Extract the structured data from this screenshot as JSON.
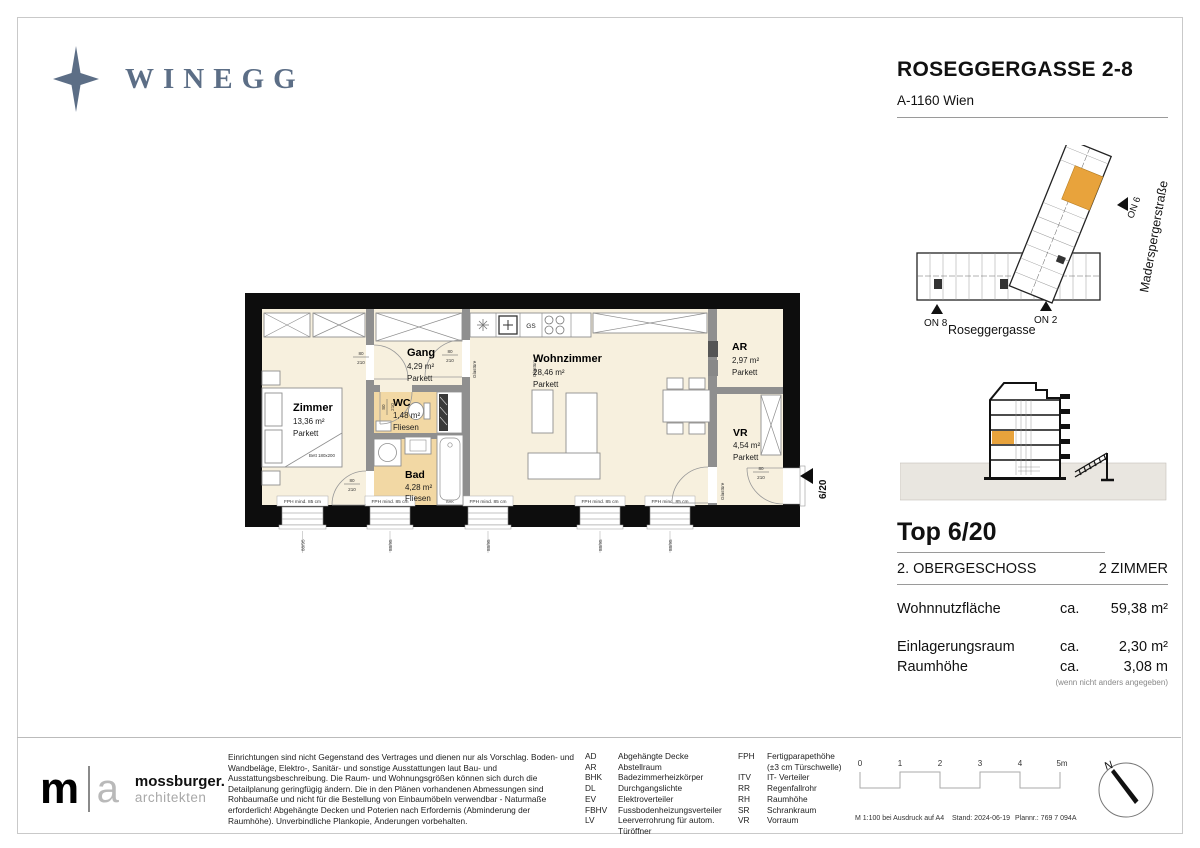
{
  "brand": {
    "name": "WINEGG",
    "color": "#5c6e86"
  },
  "header": {
    "title": "ROSEGGERGASSE 2-8",
    "subtitle": "A-1160 Wien"
  },
  "site_plan": {
    "street_bottom": "Roseggergasse",
    "street_side": "Maderspergerstraße",
    "marker_on8": "ON 8",
    "marker_on2": "ON 2",
    "marker_on6": "ON 6",
    "highlight_color": "#e8a33c"
  },
  "unit": {
    "title": "Top 6/20",
    "floor": "2. OBERGESCHOSS",
    "rooms": "2 ZIMMER",
    "metrics": [
      {
        "label": "Wohnnutzfläche",
        "approx": "ca.",
        "value": "59,38 m²"
      },
      {
        "label": "Einlagerungsraum",
        "approx": "ca.",
        "value": "2,30 m²"
      },
      {
        "label": "Raumhöhe",
        "approx": "ca.",
        "value": "3,08 m"
      }
    ],
    "note": "(wenn nicht anders angegeben)"
  },
  "plan": {
    "rooms": [
      {
        "name": "Zimmer",
        "area": "13,36 m²",
        "floor": "Parkett"
      },
      {
        "name": "Gang",
        "area": "4,29 m²",
        "floor": "Parkett"
      },
      {
        "name": "WC",
        "area": "1,48 m²",
        "floor": "Fliesen"
      },
      {
        "name": "Bad",
        "area": "4,28 m²",
        "floor": "Fliesen"
      },
      {
        "name": "Wohnzimmer",
        "area": "28,46 m²",
        "floor": "Parkett"
      },
      {
        "name": "AR",
        "area": "2,97 m²",
        "floor": "Parkett"
      },
      {
        "name": "VR",
        "area": "4,54 m²",
        "floor": "Parkett"
      }
    ],
    "bed_label": "Bett 180x200",
    "gs_label": "GS",
    "bhk_label": "BHK",
    "glass_door_label": "Glastüre",
    "door_width": "80",
    "door_height": "210",
    "window_label": "FPH mind. 85 cm",
    "window_dim": "88/95",
    "entry_marker": "6/20"
  },
  "footer": {
    "architect": {
      "m": "m",
      "a": "a",
      "name": "mossburger.",
      "sub": "architekten"
    },
    "disclaimer": "Einrichtungen sind nicht Gegenstand des Vertrages und dienen nur als Vorschlag. Boden- und Wandbeläge, Elektro-, Sanitär- und sonstige Ausstattungen laut Bau- und Ausstattungsbeschreibung. Die Raum- und Wohnungsgrößen können sich durch die Detailplanung geringfügig ändern. Die in den Plänen vorhandenen Abmessungen sind Rohbaumaße und nicht für die Bestellung von Einbaumöbeln verwendbar - Naturmaße erforderlich! Abgehängte Decken und Poterien nach Erfordernis (Abminderung der Raumhöhe). Unverbindliche Plankopie, Änderungen vorbehalten.",
    "legend_col1": [
      {
        "abbr": "AD",
        "label": "Abgehängte Decke"
      },
      {
        "abbr": "AR",
        "label": "Abstellraum"
      },
      {
        "abbr": "BHK",
        "label": "Badezimmerheizkörper"
      },
      {
        "abbr": "DL",
        "label": "Durchgangslichte"
      },
      {
        "abbr": "EV",
        "label": "Elektroverteiler"
      },
      {
        "abbr": "FBHV",
        "label": "Fussbodenheizungsverteiler"
      },
      {
        "abbr": "LV",
        "label": "Leerverrohrung für autom. Türöffner"
      }
    ],
    "legend_col2": [
      {
        "abbr": "FPH",
        "label": "Fertigparapethöhe"
      },
      {
        "abbr": "",
        "label": "(±3 cm Türschwelle)"
      },
      {
        "abbr": "ITV",
        "label": "IT- Verteiler"
      },
      {
        "abbr": "RR",
        "label": "Regenfallrohr"
      },
      {
        "abbr": "RH",
        "label": "Raumhöhe"
      },
      {
        "abbr": "SR",
        "label": "Schrankraum"
      },
      {
        "abbr": "VR",
        "label": "Vorraum"
      }
    ],
    "scale_labels": [
      "0",
      "1",
      "2",
      "3",
      "4",
      "5m"
    ],
    "print_info": [
      "M 1:100 bei Ausdruck auf A4",
      "Stand: 2024-06-19",
      "Plannr.: 769 7 094A"
    ],
    "north_label": "N"
  }
}
